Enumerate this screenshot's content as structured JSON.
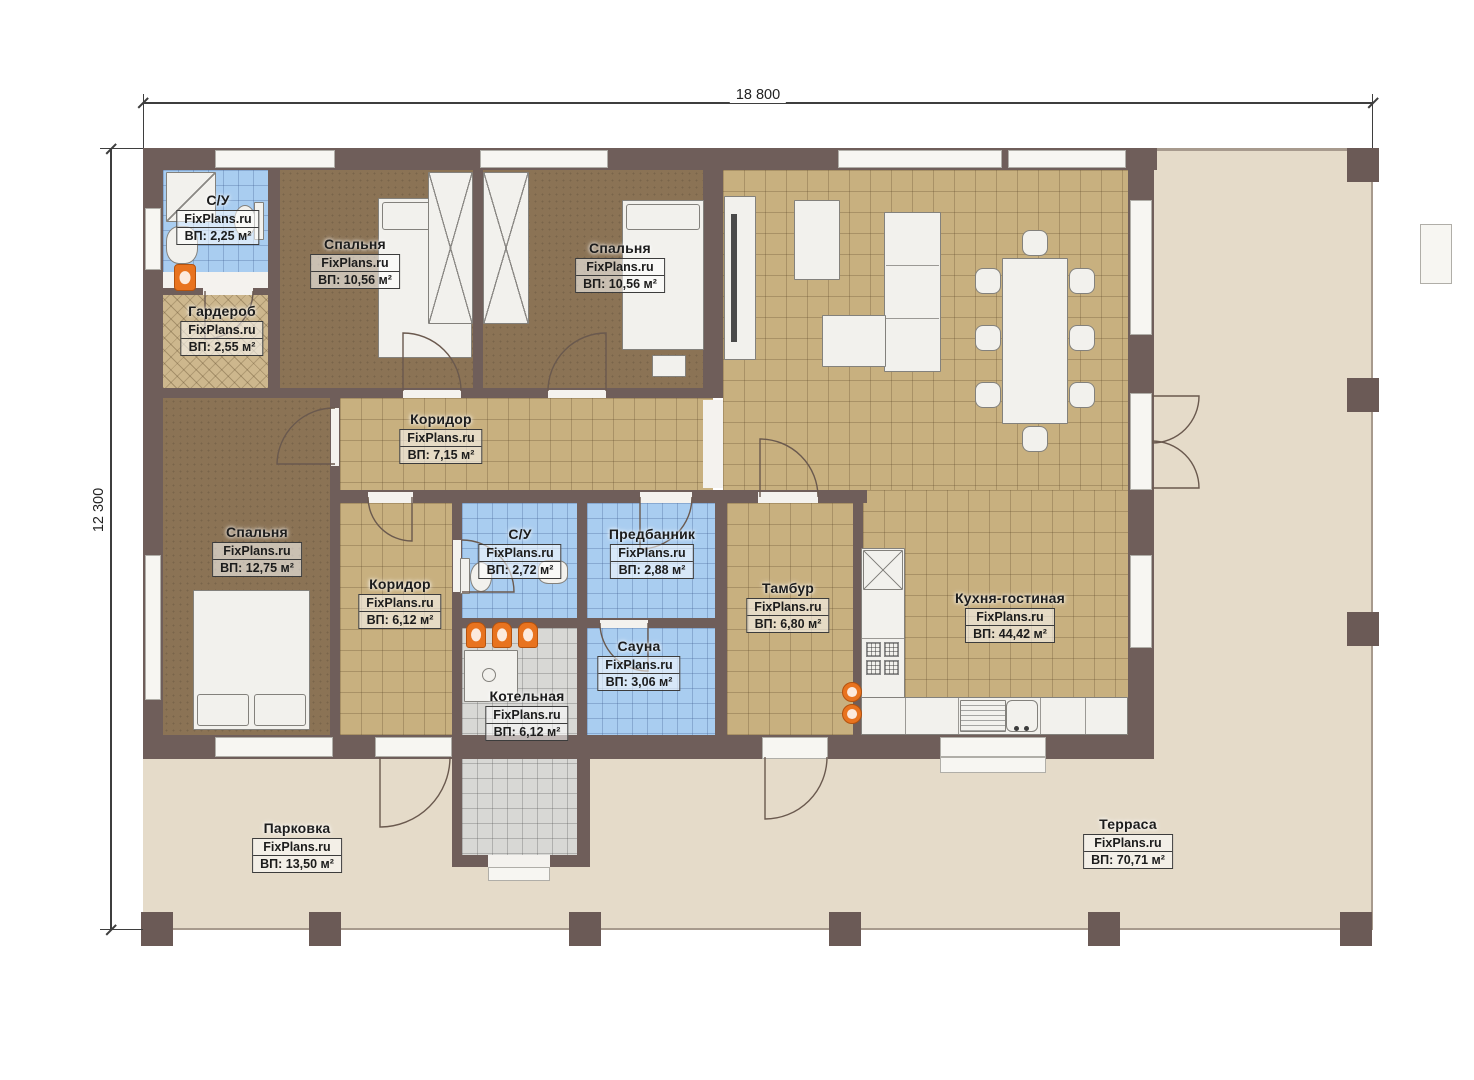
{
  "watermark": "FixPlans.ru",
  "dimensions": {
    "width": "18 800",
    "height": "12 300"
  },
  "rooms": [
    {
      "name": "С/У",
      "area": "ВП: 2,25 м²"
    },
    {
      "name": "Спальня",
      "area": "ВП: 10,56 м²"
    },
    {
      "name": "Спальня",
      "area": "ВП: 10,56 м²"
    },
    {
      "name": "Гардероб",
      "area": "ВП: 2,55 м²"
    },
    {
      "name": "Коридор",
      "area": "ВП: 7,15 м²"
    },
    {
      "name": "Спальня",
      "area": "ВП: 12,75 м²"
    },
    {
      "name": "Коридор",
      "area": "ВП: 6,12 м²"
    },
    {
      "name": "С/У",
      "area": "ВП: 2,72 м²"
    },
    {
      "name": "Предбанник",
      "area": "ВП: 2,88 м²"
    },
    {
      "name": "Тамбур",
      "area": "ВП: 6,80 м²"
    },
    {
      "name": "Сауна",
      "area": "ВП: 3,06 м²"
    },
    {
      "name": "Котельная",
      "area": "ВП: 6,12 м²"
    },
    {
      "name": "Кухня-гостиная",
      "area": "ВП: 44,42 м²"
    },
    {
      "name": "Парковка",
      "area": "ВП: 13,50 м²"
    },
    {
      "name": "Терраса",
      "area": "ВП: 70,71 м²"
    }
  ],
  "colors": {
    "wall": "#6f5e5a",
    "wood_floor": "#8b7355",
    "tile_tan": "#c8b07f",
    "tile_blue": "#a9cdf0",
    "tile_grey": "#d8d8d5",
    "terrace": "#e5dbc9",
    "fixture_orange": "#e8731f"
  }
}
